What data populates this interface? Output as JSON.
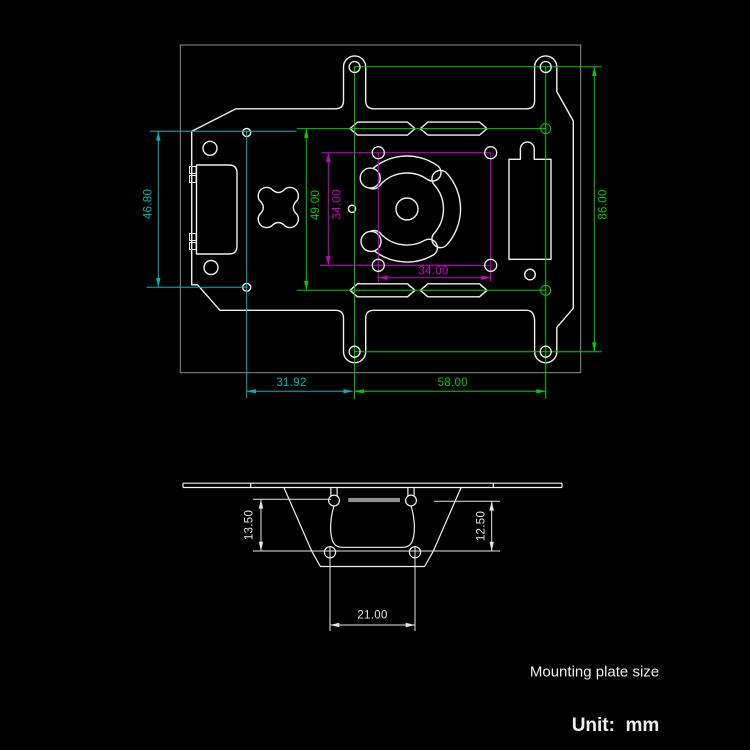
{
  "colors": {
    "background": "#000000",
    "outline": "#f0f0f0",
    "frame": "#8f8f8f",
    "green": "#00cf00",
    "cyan": "#00b6b6",
    "magenta": "#cf00cf",
    "dim_white": "#e6e6e6",
    "gray_bar": "#909090"
  },
  "top_view": {
    "dim_left_height": "46.80",
    "dim_bottom_left": "31.92",
    "dim_slot_rows": "49.00",
    "dim_square_height": "34.00",
    "dim_square_width": "34.00",
    "dim_bottom_right": "58.00",
    "dim_right_height": "86.00"
  },
  "side_view": {
    "dim_left_depth": "13.50",
    "dim_right_depth": "12.50",
    "dim_hole_spacing": "21.00"
  },
  "footer": {
    "caption": "Mounting plate size",
    "unit": "Unit:  mm"
  }
}
